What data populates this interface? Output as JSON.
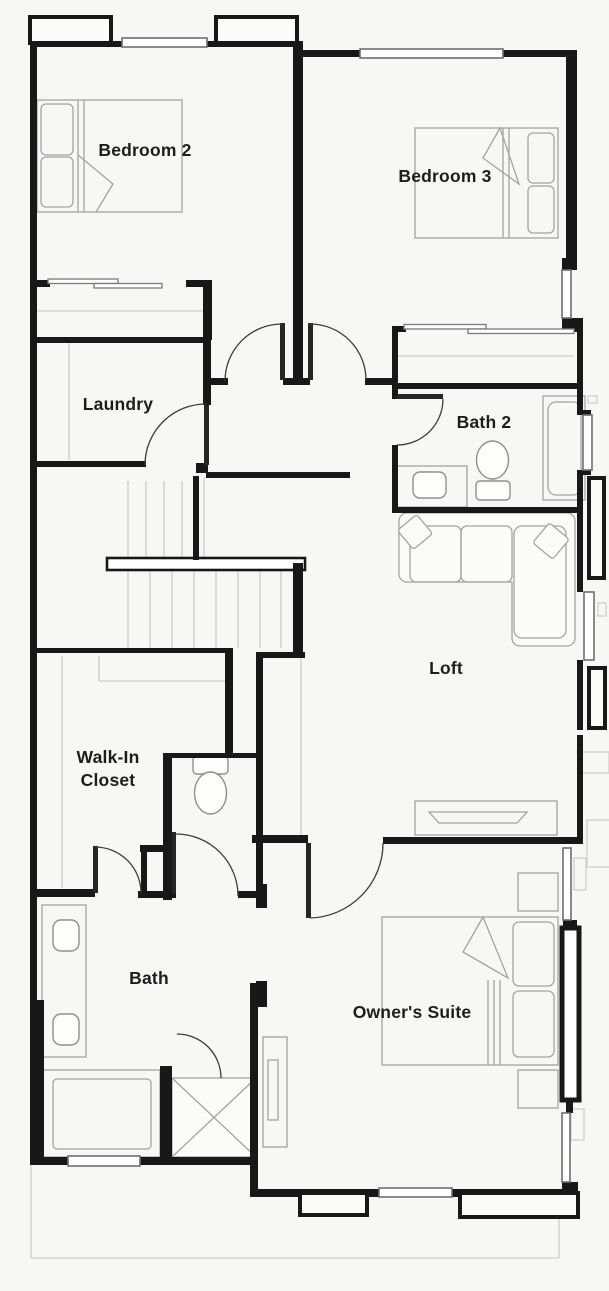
{
  "page": {
    "background": "#f7f7f6",
    "content_type": "residential second-floor plan"
  },
  "colors": {
    "wall": "#181818",
    "door_line": "#3c3c3c",
    "furniture_line": "#a3a3a3",
    "fixture_line": "#8f8f8f",
    "exterior_footprint_line": "#cfcfcf",
    "window_fill": "#ffffff",
    "label_text": "#1d1d1d"
  },
  "rooms": {
    "bedroom2": {
      "label": "Bedroom 2"
    },
    "bedroom3": {
      "label": "Bedroom 3"
    },
    "laundry": {
      "label": "Laundry"
    },
    "bath2": {
      "label": "Bath 2"
    },
    "loft": {
      "label": "Loft"
    },
    "walk_in_closet": {
      "label_line1": "Walk-In",
      "label_line2": "Closet"
    },
    "bath": {
      "label": "Bath"
    },
    "owners_suite": {
      "label": "Owner's Suite"
    }
  }
}
